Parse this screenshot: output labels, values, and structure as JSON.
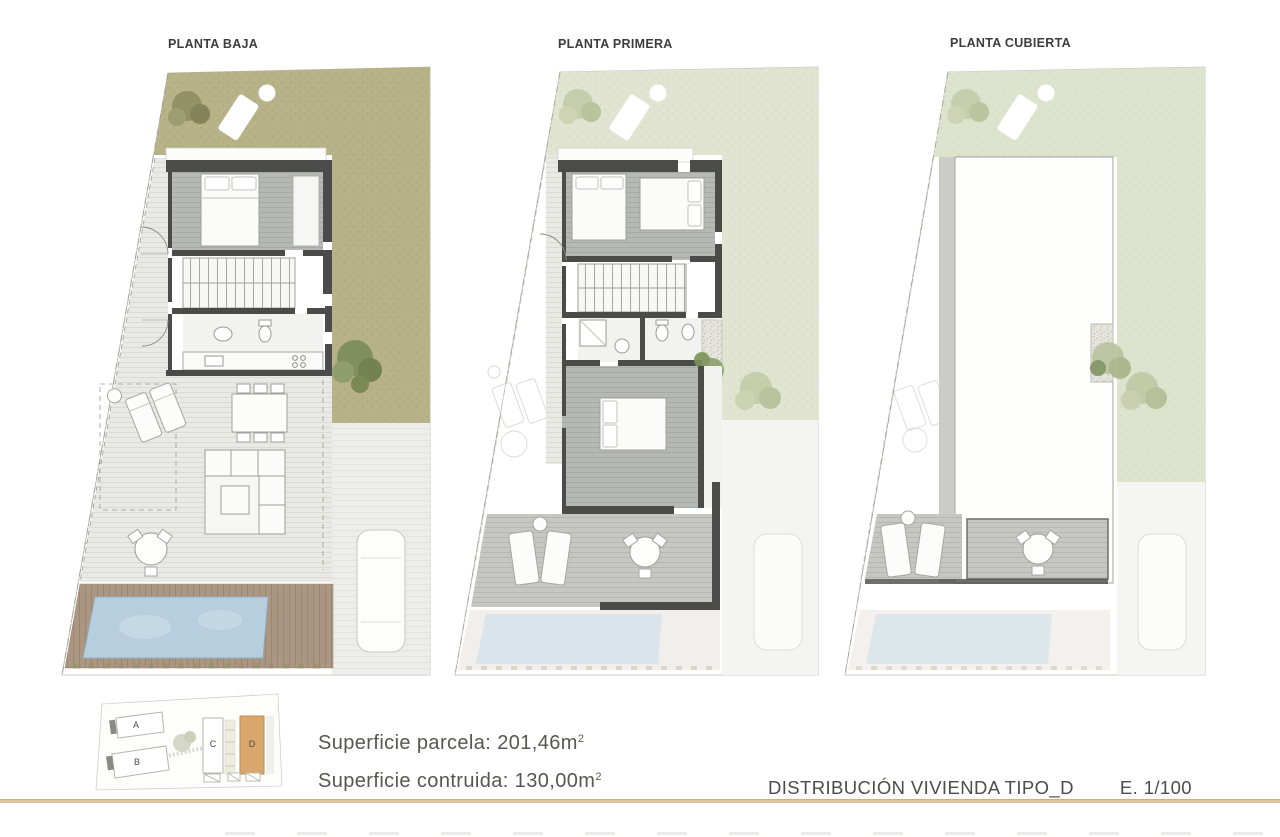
{
  "plans": [
    {
      "title": "PLANTA BAJA"
    },
    {
      "title": "PLANTA PRIMERA"
    },
    {
      "title": "PLANTA CUBIERTA"
    }
  ],
  "legend": {
    "line1": {
      "text": "Superficie parcela: 201,46m",
      "sup": "2"
    },
    "line2": {
      "text": "Superficie contruida: 130,00m",
      "sup": "2"
    }
  },
  "footer": {
    "title": "DISTRIBUCIÓN VIVIENDA TIPO_D",
    "scale": "E. 1/100"
  },
  "site_plan": {
    "lots": [
      {
        "label": "A"
      },
      {
        "label": "B"
      },
      {
        "label": "C"
      },
      {
        "label": "D",
        "highlighted": true
      }
    ],
    "highlight_color": "#d9a76c"
  },
  "colors": {
    "grass_olive": "#b7b287",
    "grass_pale": "#e0e4d0",
    "wall": "#4b4b49",
    "pool_water": "#b7cede",
    "wood_deck": "#ab9681",
    "accent_rule": "#d9c69a",
    "lot_d_highlight": "#d9a76c"
  }
}
